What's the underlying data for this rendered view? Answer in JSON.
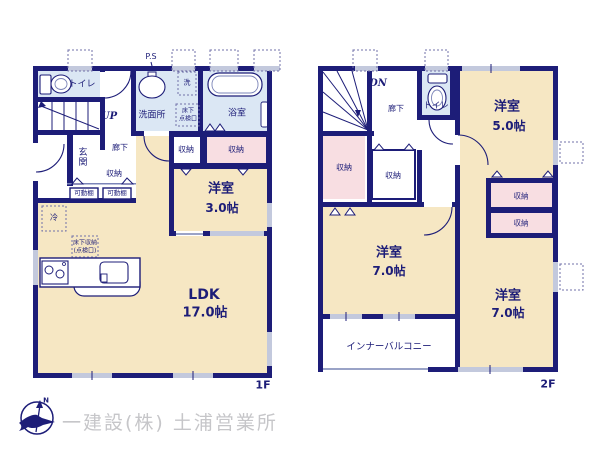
{
  "palette": {
    "wall_navy": "#1d1d78",
    "room_tan": "#f6e7c3",
    "closet_pink": "#f8dee2",
    "wet_area_blue": "#dbe7f4",
    "window_gray": "#c3c9dd",
    "logo_gray": "#c6c6c9"
  },
  "branding": {
    "company": "一建設(株) 土浦営業所",
    "compass_north": "N"
  },
  "floor1": {
    "floor_label": "1F",
    "labels": {
      "ps": "P.S",
      "toilet": "トイレ",
      "stairs_direction": "UP",
      "washroom": "洗面所",
      "laundry": "洗",
      "underfloor_access": [
        "床下",
        "点検口"
      ],
      "bath": "浴室",
      "entrance": "玄関",
      "hallway": "廊下",
      "hall_closet": "収納",
      "movable_shelf_left": "可動棚",
      "movable_shelf_right": "可動棚",
      "closet_a": "収納",
      "closet_b": "収納",
      "fridge": "冷",
      "floor_storage": [
        "床下収納",
        "(点検口)"
      ],
      "room_west_name": "洋室",
      "room_west_size": "3.0帖",
      "ldk_name": "LDK",
      "ldk_size": "17.0帖"
    }
  },
  "floor2": {
    "floor_label": "2F",
    "labels": {
      "stairs_direction": "DN",
      "hallway": "廊下",
      "toilet": "トイレ",
      "closet_left": "収納",
      "closet_mid": "収納",
      "room_ne_name": "洋室",
      "room_ne_size": "5.0帖",
      "closet_stack_top": "収納",
      "closet_stack_bottom": "収納",
      "room_sw_name": "洋室",
      "room_sw_size": "7.0帖",
      "balcony": "インナーバルコニー",
      "room_se_name": "洋室",
      "room_se_size": "7.0帖"
    }
  }
}
